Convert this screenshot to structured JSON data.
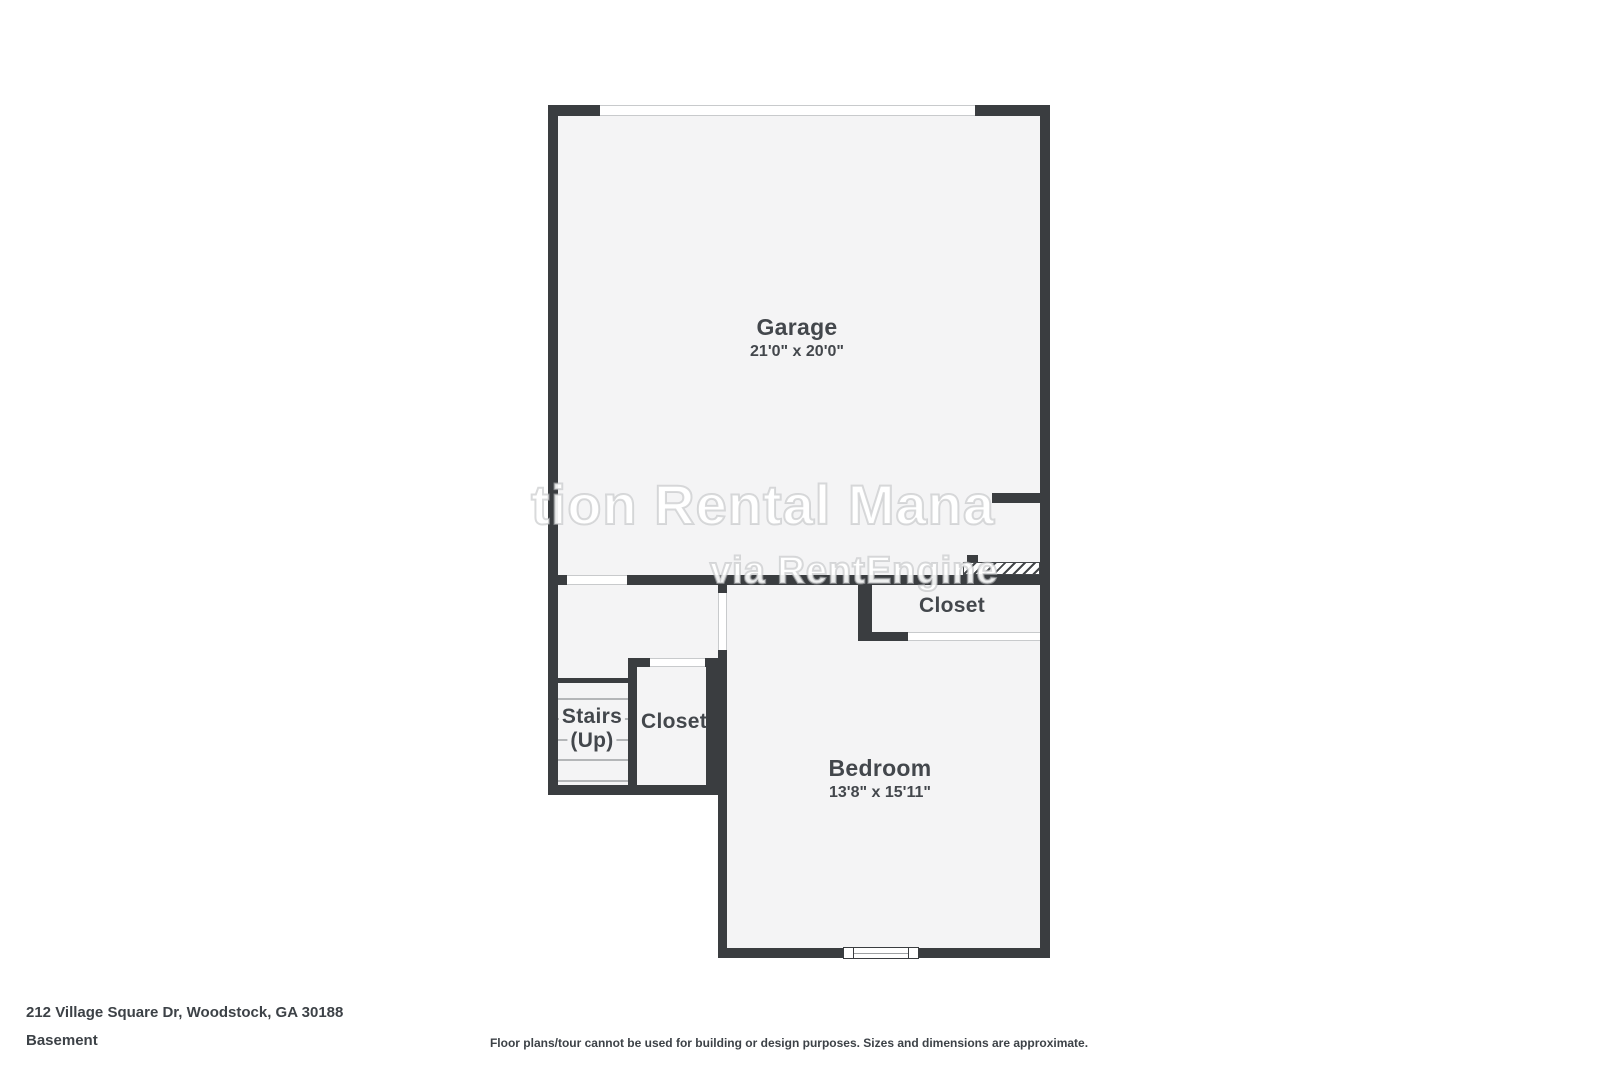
{
  "colors": {
    "wall": "#3a3d40",
    "floor_fill": "#f4f4f5",
    "label_text": "#43474c",
    "stair_tread": "#b4b6b8",
    "opening_outline": "#c8cacc"
  },
  "rooms": {
    "garage": {
      "label": "Garage",
      "dims": "21'0\" x 20'0\""
    },
    "bedroom": {
      "label": "Bedroom",
      "dims": "13'8\" x 15'11\""
    },
    "closet_upper": {
      "label": "Closet"
    },
    "closet_lower": {
      "label": "Closet"
    },
    "stairs": {
      "label": "Stairs",
      "sublabel": "(Up)"
    }
  },
  "watermark": {
    "line1": "tion Rental Mana",
    "line2": "via RentEngine"
  },
  "footer": {
    "address": "212 Village Square Dr, Woodstock, GA 30188",
    "level": "Basement",
    "disclaimer": "Floor plans/tour cannot be used for building or design purposes. Sizes and dimensions are approximate."
  }
}
